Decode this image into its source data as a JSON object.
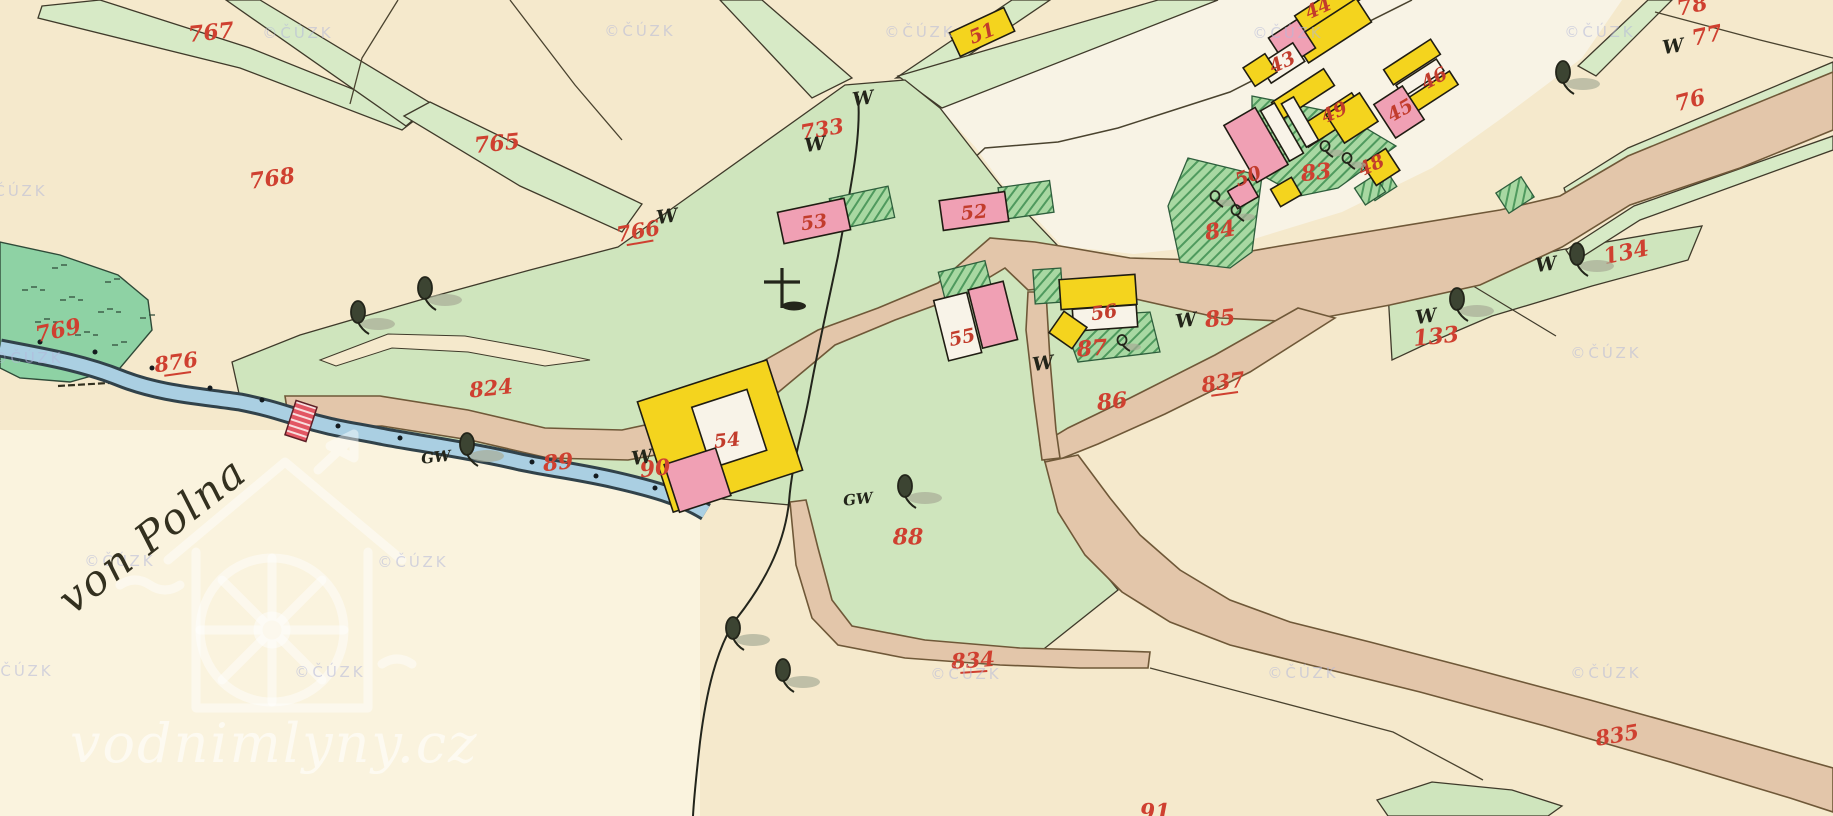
{
  "map": {
    "kind": "historic hand-colored cadastral map sheet",
    "annotation": {
      "text": "von Polna",
      "x": 152,
      "y": 535,
      "rot": -38
    },
    "site_watermark": {
      "text": "vodnimlyny.cz",
      "x": 70,
      "y": 762
    },
    "watermark": {
      "text": "©ČÚZK",
      "positions": [
        [
          298,
          38
        ],
        [
          640,
          36
        ],
        [
          920,
          37
        ],
        [
          1288,
          38
        ],
        [
          1600,
          37
        ],
        [
          12,
          196
        ],
        [
          28,
          363
        ],
        [
          1606,
          358
        ],
        [
          120,
          566
        ],
        [
          413,
          567
        ],
        [
          18,
          676
        ],
        [
          330,
          677
        ],
        [
          966,
          679
        ],
        [
          1303,
          678
        ],
        [
          1606,
          678
        ]
      ]
    },
    "colors": {
      "paper": "#f5e9cc",
      "paper_light": "#faf3de",
      "village_ground": "#f8f3e5",
      "meadow": "#cfe5bd",
      "meadow_bright": "#8ed2a4",
      "lane_green": "#d7eac6",
      "garden_green": "#a8d8a2",
      "garden_hatch": "#4f9a5e",
      "road_fill": "#e3c6aa",
      "road_edge": "#6f5838",
      "stream_fill": "#aacfe2",
      "stream_edge": "#31424a",
      "building_yellow": "#f4d41e",
      "building_pink": "#f0a0b4",
      "building_white": "#f8f3e8",
      "bridge_red": "#e25663",
      "label_red": "#cf4030",
      "ink": "#32301f",
      "tree_green": "#3c4432",
      "shadow_gray": "#a8ad97",
      "watermark_lavender": "#b4b8da"
    },
    "labels": {
      "field_parcels": [
        {
          "text": "767",
          "x": 211,
          "y": 32,
          "rot": -6
        },
        {
          "text": "765",
          "x": 497,
          "y": 143,
          "rot": -6
        },
        {
          "text": "768",
          "x": 272,
          "y": 178,
          "rot": -8
        },
        {
          "text": "769",
          "x": 58,
          "y": 330,
          "rot": -12
        },
        {
          "text": "76",
          "x": 1690,
          "y": 100,
          "rot": -15
        },
        {
          "text": "77",
          "x": 1707,
          "y": 35,
          "rot": -12
        },
        {
          "text": "78",
          "x": 1692,
          "y": 5,
          "rot": -12
        },
        {
          "text": "85",
          "x": 1220,
          "y": 318,
          "rot": -6
        },
        {
          "text": "86",
          "x": 1112,
          "y": 401,
          "rot": -6
        },
        {
          "text": "88",
          "x": 908,
          "y": 537,
          "rot": 0
        },
        {
          "text": "91",
          "x": 1155,
          "y": 812,
          "rot": 0
        },
        {
          "text": "133",
          "x": 1436,
          "y": 336,
          "rot": -6
        },
        {
          "text": "134",
          "x": 1626,
          "y": 252,
          "rot": -12
        },
        {
          "text": "83",
          "x": 1316,
          "y": 172,
          "rot": -6
        },
        {
          "text": "84",
          "x": 1220,
          "y": 230,
          "rot": -10
        },
        {
          "text": "87",
          "x": 1092,
          "y": 348,
          "rot": -4
        },
        {
          "text": "89",
          "x": 558,
          "y": 462,
          "rot": -6
        },
        {
          "text": "90",
          "x": 655,
          "y": 468,
          "rot": -6
        }
      ],
      "road_water_parcels": [
        {
          "text": "876",
          "x": 176,
          "y": 362,
          "rot": -8,
          "underline": true
        },
        {
          "text": "824",
          "x": 491,
          "y": 388,
          "rot": -6
        },
        {
          "text": "766",
          "x": 638,
          "y": 231,
          "rot": -10,
          "underline": true
        },
        {
          "text": "733",
          "x": 822,
          "y": 129,
          "rot": -10
        },
        {
          "text": "834",
          "x": 973,
          "y": 660,
          "rot": -4,
          "underline": true
        },
        {
          "text": "835",
          "x": 1617,
          "y": 735,
          "rot": -10
        },
        {
          "text": "837",
          "x": 1223,
          "y": 382,
          "rot": -8,
          "underline": true
        }
      ],
      "building_numbers": [
        {
          "text": "43",
          "x": 1282,
          "y": 62,
          "rot": -25
        },
        {
          "text": "44",
          "x": 1318,
          "y": 8,
          "rot": -25
        },
        {
          "text": "45",
          "x": 1400,
          "y": 110,
          "rot": -30
        },
        {
          "text": "46",
          "x": 1434,
          "y": 78,
          "rot": -28
        },
        {
          "text": "48",
          "x": 1371,
          "y": 165,
          "rot": -25
        },
        {
          "text": "49",
          "x": 1334,
          "y": 112,
          "rot": -25
        },
        {
          "text": "50",
          "x": 1248,
          "y": 176,
          "rot": -20
        },
        {
          "text": "51",
          "x": 982,
          "y": 33,
          "rot": -22
        },
        {
          "text": "52",
          "x": 974,
          "y": 212,
          "rot": -6
        },
        {
          "text": "53",
          "x": 814,
          "y": 222,
          "rot": -8
        },
        {
          "text": "54",
          "x": 727,
          "y": 440,
          "rot": -6
        },
        {
          "text": "55",
          "x": 962,
          "y": 337,
          "rot": -12
        },
        {
          "text": "56",
          "x": 1104,
          "y": 312,
          "rot": -8
        }
      ],
      "culture_symbols_W": [
        [
          863,
          98
        ],
        [
          815,
          144
        ],
        [
          667,
          216
        ],
        [
          642,
          457
        ],
        [
          1043,
          363
        ],
        [
          1186,
          320
        ],
        [
          1426,
          316
        ],
        [
          1546,
          264
        ],
        [
          1673,
          46
        ]
      ],
      "culture_symbols_GW": [
        [
          436,
          457
        ],
        [
          858,
          499
        ]
      ]
    },
    "features": {
      "wayside_cross": {
        "x": 782,
        "y": 288
      },
      "bridge": {
        "x": 301,
        "y": 421
      },
      "trees_large": [
        [
          358,
          312
        ],
        [
          425,
          288
        ],
        [
          467,
          444
        ],
        [
          905,
          486
        ],
        [
          733,
          628
        ],
        [
          783,
          670
        ],
        [
          1563,
          72
        ],
        [
          1577,
          254
        ],
        [
          1457,
          299
        ]
      ],
      "trees_garden": [
        [
          1325,
          146
        ],
        [
          1347,
          158
        ],
        [
          1215,
          196
        ],
        [
          1236,
          210
        ],
        [
          1122,
          340
        ]
      ],
      "stream_dots": [
        [
          40,
          342
        ],
        [
          95,
          352
        ],
        [
          152,
          368
        ],
        [
          210,
          388
        ],
        [
          262,
          400
        ],
        [
          338,
          426
        ],
        [
          400,
          438
        ],
        [
          465,
          448
        ],
        [
          532,
          462
        ],
        [
          596,
          476
        ],
        [
          655,
          488
        ]
      ]
    }
  }
}
